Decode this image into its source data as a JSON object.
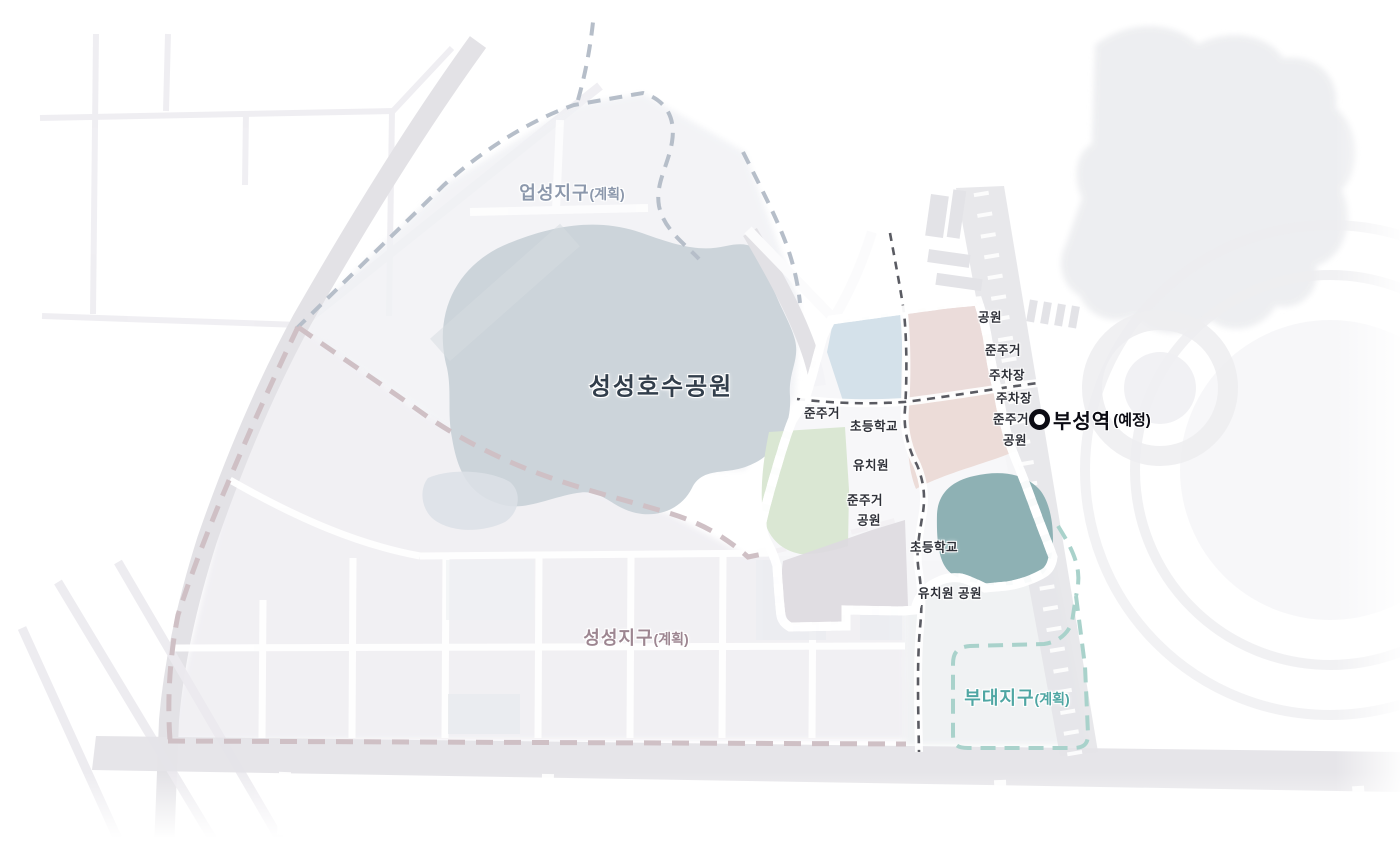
{
  "map": {
    "district_labels": [
      {
        "name": "eupseong",
        "text": "업성지구",
        "suffix": "(계획)",
        "x": 572,
        "y": 192,
        "color": "#8c98ac"
      },
      {
        "name": "seongseong-lake-park",
        "text": "성성호수공원",
        "suffix": "",
        "x": 661,
        "y": 384,
        "color": "#323e4b"
      },
      {
        "name": "seongseong",
        "text": "성성지구",
        "suffix": "(계획)",
        "x": 636,
        "y": 637,
        "color": "#9d8691"
      },
      {
        "name": "budae",
        "text": "부대지구",
        "suffix": "(계획)",
        "x": 1017,
        "y": 697,
        "color": "#4fa6a3"
      }
    ],
    "station": {
      "text": "부성역",
      "suffix": "(예정)"
    },
    "zone_labels": [
      {
        "text": "준주거",
        "x": 822,
        "y": 412
      },
      {
        "text": "초등학교",
        "x": 874,
        "y": 425
      },
      {
        "text": "유치원",
        "x": 871,
        "y": 464
      },
      {
        "text": "준주거",
        "x": 865,
        "y": 499
      },
      {
        "text": "공원",
        "x": 869,
        "y": 519
      },
      {
        "text": "초등학교",
        "x": 934,
        "y": 546
      },
      {
        "text": "유치원",
        "x": 936,
        "y": 592
      },
      {
        "text": "공원",
        "x": 970,
        "y": 592
      },
      {
        "text": "공원",
        "x": 990,
        "y": 316
      },
      {
        "text": "준주거",
        "x": 1003,
        "y": 349
      },
      {
        "text": "주차장",
        "x": 1007,
        "y": 374
      },
      {
        "text": "주차장",
        "x": 1014,
        "y": 397
      },
      {
        "text": "준주거",
        "x": 1011,
        "y": 418
      },
      {
        "text": "공원",
        "x": 1015,
        "y": 439
      }
    ],
    "colors": {
      "boundary_red": "#d7232e",
      "boundary_mauve": "#cfc0c5",
      "boundary_blue_gray": "#b6bec9",
      "boundary_teal": "#a9d2cb",
      "zone_blue": "#d4e1ea",
      "zone_pink": "#ebdcda",
      "zone_green": "#dae7d3",
      "zone_teal": "#8eb1b4",
      "zone_lavender": "#dddae0",
      "lake": "#ccd4da",
      "inner_road_dash": "#5a5b62"
    }
  }
}
